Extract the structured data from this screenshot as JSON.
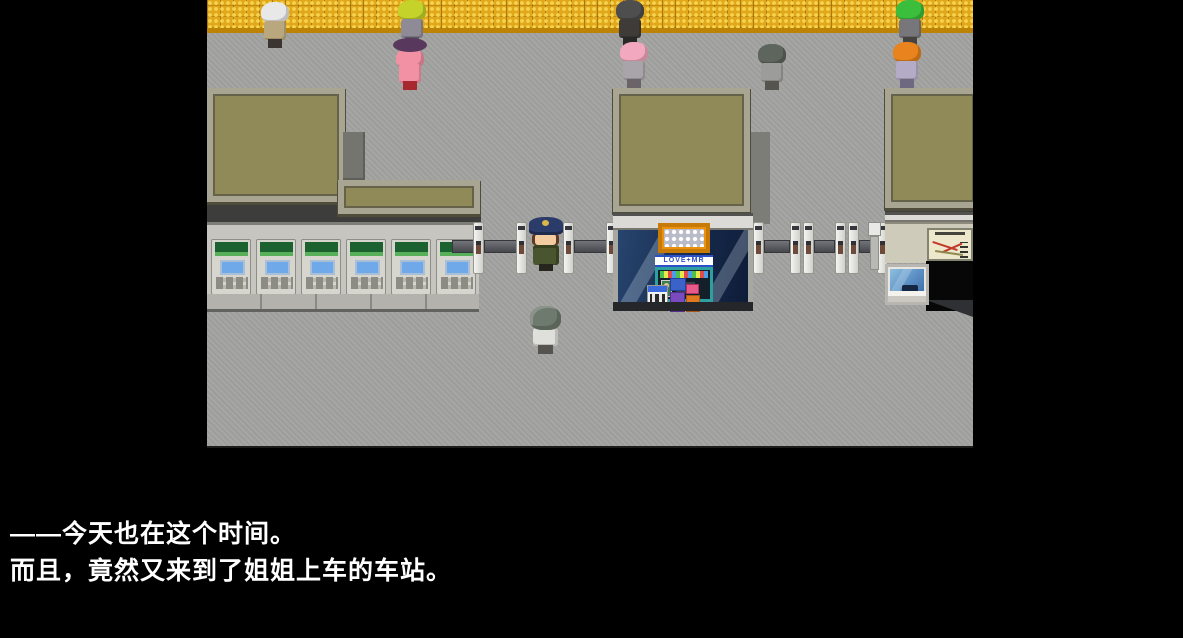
{
  "game": {
    "dialogue": {
      "line1": "——今天也在这个时间。",
      "line2": "而且，竟然又来到了姐姐上车的车站。"
    },
    "kiosk": {
      "sign": "LOVE+MR"
    },
    "station": {
      "ticket_machines": {
        "count": 6,
        "panel_color": "#1C6130",
        "screen_color": "#6FA9E9"
      },
      "ticket_gates": {
        "left_row_pillars": 4,
        "right_row_pillars": 6
      },
      "npcs": [
        {
          "id": "npc-white-hair",
          "hair_color": "#E8E8E8",
          "outfit_color": "#B9A87D"
        },
        {
          "id": "npc-lime-hair",
          "hair_color": "#C4D22A",
          "outfit_color": "#8E8A96"
        },
        {
          "id": "npc-hat-lady",
          "hat_color": "#58385C",
          "outfit_color": "#F291A4"
        },
        {
          "id": "npc-dark-hair-man",
          "hair_color": "#4E4E4E",
          "outfit_color": "#3E3B38"
        },
        {
          "id": "npc-pink-hair",
          "hair_color": "#F2A8BE",
          "outfit_color": "#A9A4AA"
        },
        {
          "id": "npc-gray-bob",
          "hair_color": "#5E655C",
          "outfit_color": "#9C9C9A"
        },
        {
          "id": "npc-green-hair",
          "hair_color": "#3BBE3B",
          "outfit_color": "#77777B"
        },
        {
          "id": "npc-orange-hair",
          "hair_color": "#E8831E",
          "outfit_color": "#B4ABC6"
        },
        {
          "id": "station-attendant",
          "hat_color": "#2B3C6B",
          "uniform_color": "#49552F"
        },
        {
          "id": "player-character",
          "hair_color": "#6F7A6E",
          "jacket_color": "#DFDFDC"
        }
      ]
    },
    "colors": {
      "background": "#000000",
      "floor": "#A3A3A1",
      "tactile_paving": "#E2A81C",
      "roof": "#8F8A58",
      "roof_border": "#A9A593",
      "kiosk_sign_frame": "#E9920F",
      "kiosk_glass": "#16294B",
      "dialogue_text": "#FFFFFF"
    }
  }
}
